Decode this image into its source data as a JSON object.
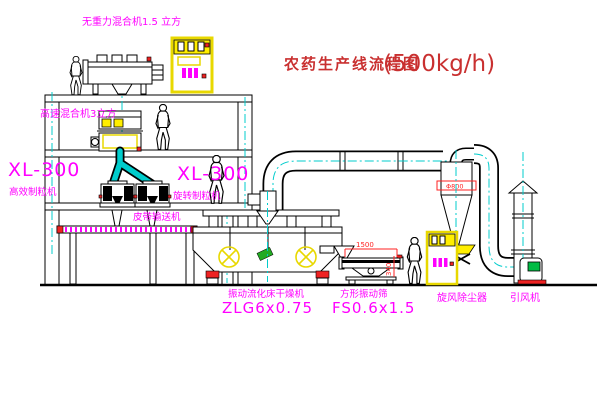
{
  "title": {
    "text": "农药生产线流程图",
    "capacity": "(500kg/h)"
  },
  "equipment": {
    "top_mixer_label": "无重力混合机1.5 立方",
    "floor2_mixer_label": "高速混合机3立方",
    "granulator_left": {
      "model": "XL-300",
      "name": "高效制粒机"
    },
    "granulator_mid": {
      "model": "XL-300",
      "name": "旋转制粒机"
    },
    "belt_conveyor": "皮带输送机",
    "dryer": {
      "name": "振动流化床干燥机",
      "model": "ZLG6x0.75"
    },
    "sieve": {
      "name": "方形振动筛",
      "model": "FS0.6x1.5"
    },
    "cyclone": "旋风除尘器",
    "fan": "引风机"
  },
  "dimensions": {
    "cyclone_diameter": "Φ800",
    "sieve_length": "1500",
    "sieve_height": "340"
  },
  "colors": {
    "label_magenta": "#FF00FF",
    "title_red": "#C93030",
    "centerline_cyan": "#00CCCC",
    "cabinet_yellow": "#FFEE00",
    "accent_red": "#EE2222",
    "motor_green": "#00BB44"
  },
  "icons": {
    "person": "worker-figure",
    "cabinet": "control-cabinet",
    "dryer_symbol": "circle-cross-vibrator"
  }
}
